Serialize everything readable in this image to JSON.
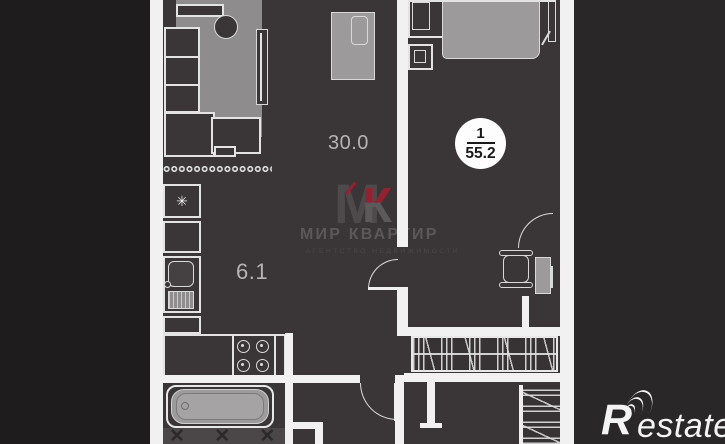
{
  "plan": {
    "badge": {
      "rooms_count": "1",
      "total_area": "55.2"
    },
    "room_labels": {
      "living_kitchen_area": "30.0",
      "kitchen_niche_area": "6.1"
    }
  },
  "watermark": {
    "monogram_m": "М",
    "monogram_k": "К",
    "agency_name": "МИР КВАРТИР",
    "agency_tagline": "АГЕНТСТВО НЕДВИЖИМОСТИ"
  },
  "branding": {
    "logo_text_r": "R",
    "logo_text_rest": "estate"
  },
  "glyphs": {
    "snowflake": "✳",
    "tile_crosses": "✕ ✕ ✕ ✕ ✕"
  },
  "colors": {
    "background": "#2a2728",
    "background_left": "#1f1c1d",
    "floor": "#3a3637",
    "wall_white": "#f2f1f1",
    "furniture_gray": "#9c9a9b",
    "rug_gray": "#8e8c8d",
    "outline_white": "#e3e3e3",
    "watermark_gray": "#5c5859",
    "watermark_red": "#96202f",
    "label_gray": "#b5b3b4",
    "badge_bg": "#fdfdfd",
    "badge_text": "#1a1a1a"
  }
}
